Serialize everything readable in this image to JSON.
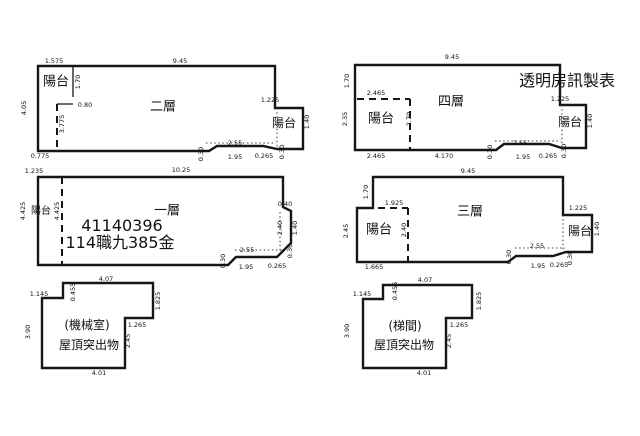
{
  "sheet": {
    "background": "#ffffff",
    "line_color": "#161616",
    "maker_label": "透明房訊製表",
    "plan_titles": [
      "二層",
      "四層",
      "一層",
      "三層",
      "屋頂突出物(機械室)",
      "屋頂突出物(梯間)"
    ],
    "case_number": "41140396",
    "case_text": "114職九385金"
  },
  "labels": [
    {
      "name": "floor2-dim-top-left",
      "text": "1.575",
      "x": 54,
      "y": 61,
      "r": 0
    },
    {
      "name": "floor2-dim-top",
      "text": "9.45",
      "x": 180,
      "y": 61,
      "r": 0
    },
    {
      "name": "floor2-dim-left",
      "text": "4.05",
      "x": 24,
      "y": 108,
      "r": 1
    },
    {
      "name": "floor2-balcony-left-label",
      "text": "陽台",
      "x": 56,
      "y": 82,
      "r": 0,
      "s": 13
    },
    {
      "name": "floor2-dim-balcony-height",
      "text": "1.70",
      "x": 78,
      "y": 82,
      "r": 1
    },
    {
      "name": "floor2-dim-080",
      "text": "0.80",
      "x": 85,
      "y": 105,
      "r": 0
    },
    {
      "name": "floor2-dim-3775",
      "text": "3.775",
      "x": 62,
      "y": 124,
      "r": 1
    },
    {
      "name": "floor2-dim-bottom-left",
      "text": "0.775",
      "x": 40,
      "y": 156,
      "r": 0
    },
    {
      "name": "floor2-title",
      "text": "二層",
      "x": 163,
      "y": 107,
      "r": 0,
      "s": 13
    },
    {
      "name": "floor2-dim-1225",
      "text": "1.225",
      "x": 270,
      "y": 100,
      "r": 0
    },
    {
      "name": "floor2-balcony-right-label",
      "text": "陽台",
      "x": 284,
      "y": 123,
      "r": 0,
      "s": 12
    },
    {
      "name": "floor2-dim-140",
      "text": "1.40",
      "x": 307,
      "y": 122,
      "r": 1
    },
    {
      "name": "floor2-dim-030-left",
      "text": "0.30",
      "x": 201,
      "y": 154,
      "r": 1
    },
    {
      "name": "floor2-dim-255",
      "text": "2.55",
      "x": 235,
      "y": 143,
      "r": 0
    },
    {
      "name": "floor2-dim-195",
      "text": "1.95",
      "x": 235,
      "y": 157,
      "r": 0
    },
    {
      "name": "floor2-dim-0265",
      "text": "0.265",
      "x": 264,
      "y": 156,
      "r": 0
    },
    {
      "name": "floor2-dim-030-right",
      "text": "0.30",
      "x": 282,
      "y": 152,
      "r": 1
    },
    {
      "name": "floor4-dim-top",
      "text": "9.45",
      "x": 452,
      "y": 57,
      "r": 0
    },
    {
      "name": "floor4-dim-left-top",
      "text": "1.70",
      "x": 347,
      "y": 81,
      "r": 1
    },
    {
      "name": "floor4-dim-2465-top",
      "text": "2.465",
      "x": 376,
      "y": 93,
      "r": 0
    },
    {
      "name": "floor4-balcony-left-label",
      "text": "陽台",
      "x": 381,
      "y": 119,
      "r": 0,
      "s": 13
    },
    {
      "name": "floor4-dim-left-bottom",
      "text": "2.35",
      "x": 345,
      "y": 119,
      "r": 1
    },
    {
      "name": "floor4-dim-270",
      "text": "2.70",
      "x": 409,
      "y": 119,
      "r": 1
    },
    {
      "name": "floor4-title",
      "text": "四層",
      "x": 451,
      "y": 102,
      "r": 0,
      "s": 13
    },
    {
      "name": "floor4-dim-2465-bottom",
      "text": "2.465",
      "x": 376,
      "y": 156,
      "r": 0
    },
    {
      "name": "floor4-dim-4170",
      "text": "4.170",
      "x": 444,
      "y": 156,
      "r": 0
    },
    {
      "name": "floor4-dim-030-left",
      "text": "0.30",
      "x": 490,
      "y": 152,
      "r": 1
    },
    {
      "name": "floor4-dim-255",
      "text": "2.55",
      "x": 520,
      "y": 143,
      "r": 0
    },
    {
      "name": "floor4-dim-195",
      "text": "1.95",
      "x": 523,
      "y": 157,
      "r": 0
    },
    {
      "name": "floor4-dim-0265",
      "text": "0.265",
      "x": 548,
      "y": 156,
      "r": 0
    },
    {
      "name": "floor4-dim-030-right",
      "text": "0.30",
      "x": 564,
      "y": 151,
      "r": 1
    },
    {
      "name": "floor4-dim-1225",
      "text": "1.225",
      "x": 560,
      "y": 99,
      "r": 0
    },
    {
      "name": "floor4-balcony-right-label",
      "text": "陽台",
      "x": 570,
      "y": 122,
      "r": 0,
      "s": 12
    },
    {
      "name": "floor4-dim-140",
      "text": "1.40",
      "x": 590,
      "y": 121,
      "r": 1
    },
    {
      "name": "maker-label",
      "text": "透明房訊製表",
      "x": 567,
      "y": 81,
      "r": 0,
      "s": 16
    },
    {
      "name": "floor1-dim-top-left",
      "text": "1.235",
      "x": 34,
      "y": 171,
      "r": 0
    },
    {
      "name": "floor1-dim-top",
      "text": "10.25",
      "x": 181,
      "y": 170,
      "r": 0
    },
    {
      "name": "floor1-balcony-label",
      "text": "陽台",
      "x": 41,
      "y": 212,
      "r": 0,
      "s": 10
    },
    {
      "name": "floor1-dim-left",
      "text": "4.425",
      "x": 23,
      "y": 211,
      "r": 1
    },
    {
      "name": "floor1-dim-dashed",
      "text": "4.425",
      "x": 57,
      "y": 211,
      "r": 1
    },
    {
      "name": "floor1-title",
      "text": "一層",
      "x": 167,
      "y": 211,
      "r": 0,
      "s": 13
    },
    {
      "name": "floor1-case-number",
      "text": "41140396",
      "x": 122,
      "y": 226,
      "r": 0,
      "s": 16
    },
    {
      "name": "floor1-case-text",
      "text": "114職九385金",
      "x": 120,
      "y": 243,
      "r": 0,
      "s": 16
    },
    {
      "name": "floor1-dim-040",
      "text": "0.40",
      "x": 285,
      "y": 204,
      "r": 0
    },
    {
      "name": "floor1-dim-240",
      "text": "2.40",
      "x": 280,
      "y": 228,
      "r": 1
    },
    {
      "name": "floor1-dim-140",
      "text": "1.40",
      "x": 295,
      "y": 228,
      "r": 1
    },
    {
      "name": "floor1-dim-030-right",
      "text": "0.30",
      "x": 290,
      "y": 251,
      "r": 1
    },
    {
      "name": "floor1-dim-030-left",
      "text": "0.30",
      "x": 223,
      "y": 261,
      "r": 1
    },
    {
      "name": "floor1-dim-255",
      "text": "2.55",
      "x": 247,
      "y": 250,
      "r": 0
    },
    {
      "name": "floor1-dim-195",
      "text": "1.95",
      "x": 246,
      "y": 267,
      "r": 0
    },
    {
      "name": "floor1-dim-0265",
      "text": "0.265",
      "x": 277,
      "y": 266,
      "r": 0
    },
    {
      "name": "floor3-dim-top",
      "text": "9.45",
      "x": 468,
      "y": 171,
      "r": 0
    },
    {
      "name": "floor3-dim-left-top",
      "text": "1.70",
      "x": 366,
      "y": 192,
      "r": 1
    },
    {
      "name": "floor3-dim-1925",
      "text": "1.925",
      "x": 394,
      "y": 203,
      "r": 0
    },
    {
      "name": "floor3-balcony-left-label",
      "text": "陽台",
      "x": 379,
      "y": 230,
      "r": 0,
      "s": 13
    },
    {
      "name": "floor3-dim-left",
      "text": "2.45",
      "x": 346,
      "y": 231,
      "r": 1
    },
    {
      "name": "floor3-dim-dashed",
      "text": "2.40",
      "x": 404,
      "y": 230,
      "r": 1
    },
    {
      "name": "floor3-title",
      "text": "三層",
      "x": 470,
      "y": 212,
      "r": 0,
      "s": 13
    },
    {
      "name": "floor3-dim-bottom-left",
      "text": "1.665",
      "x": 374,
      "y": 267,
      "r": 0
    },
    {
      "name": "floor3-dim-030-left",
      "text": "0.30",
      "x": 509,
      "y": 257,
      "r": 1
    },
    {
      "name": "floor3-dim-255",
      "text": "2.55",
      "x": 537,
      "y": 246,
      "r": 0
    },
    {
      "name": "floor3-dim-195",
      "text": "1.95",
      "x": 538,
      "y": 266,
      "r": 0
    },
    {
      "name": "floor3-dim-0265",
      "text": "0.265",
      "x": 559,
      "y": 265,
      "r": 0
    },
    {
      "name": "floor3-dim-030-right",
      "text": "0.30",
      "x": 570,
      "y": 258,
      "r": 1
    },
    {
      "name": "floor3-dim-1225",
      "text": "1.225",
      "x": 578,
      "y": 208,
      "r": 0
    },
    {
      "name": "floor3-balcony-right-label",
      "text": "陽台",
      "x": 580,
      "y": 231,
      "r": 0,
      "s": 12
    },
    {
      "name": "floor3-dim-140",
      "text": "1.40",
      "x": 597,
      "y": 229,
      "r": 1
    },
    {
      "name": "roof1-dim-top",
      "text": "4.07",
      "x": 106,
      "y": 279,
      "r": 0
    },
    {
      "name": "roof1-dim-1145",
      "text": "1.145",
      "x": 39,
      "y": 294,
      "r": 0
    },
    {
      "name": "roof1-dim-0455",
      "text": "0.455",
      "x": 73,
      "y": 292,
      "r": 1
    },
    {
      "name": "roof1-dim-1825",
      "text": "1.825",
      "x": 158,
      "y": 301,
      "r": 1
    },
    {
      "name": "roof1-room-label",
      "text": "(機械室)",
      "x": 87,
      "y": 325,
      "r": 0,
      "s": 12
    },
    {
      "name": "roof1-dim-1265",
      "text": "1.265",
      "x": 137,
      "y": 325,
      "r": 0
    },
    {
      "name": "roof1-dim-245",
      "text": "2.45",
      "x": 128,
      "y": 341,
      "r": 1
    },
    {
      "name": "roof1-dim-390",
      "text": "3.90",
      "x": 28,
      "y": 332,
      "r": 1
    },
    {
      "name": "roof1-title",
      "text": "屋頂突出物",
      "x": 89,
      "y": 345,
      "r": 0,
      "s": 12
    },
    {
      "name": "roof1-dim-bottom",
      "text": "4.01",
      "x": 99,
      "y": 373,
      "r": 0
    },
    {
      "name": "roof2-dim-top",
      "text": "4.07",
      "x": 425,
      "y": 280,
      "r": 0
    },
    {
      "name": "roof2-dim-1145",
      "text": "1.145",
      "x": 362,
      "y": 294,
      "r": 0
    },
    {
      "name": "roof2-dim-0455",
      "text": "0.455",
      "x": 395,
      "y": 291,
      "r": 1
    },
    {
      "name": "roof2-dim-1825",
      "text": "1.825",
      "x": 479,
      "y": 301,
      "r": 1
    },
    {
      "name": "roof2-room-label",
      "text": "(梯間)",
      "x": 405,
      "y": 326,
      "r": 0,
      "s": 12
    },
    {
      "name": "roof2-dim-1265",
      "text": "1.265",
      "x": 459,
      "y": 325,
      "r": 0
    },
    {
      "name": "roof2-dim-245",
      "text": "2.45",
      "x": 449,
      "y": 341,
      "r": 1
    },
    {
      "name": "roof2-dim-390",
      "text": "3.90",
      "x": 347,
      "y": 331,
      "r": 1
    },
    {
      "name": "roof2-title",
      "text": "屋頂突出物",
      "x": 404,
      "y": 345,
      "r": 0,
      "s": 12
    },
    {
      "name": "roof2-dim-bottom",
      "text": "4.01",
      "x": 424,
      "y": 373,
      "r": 0
    }
  ]
}
